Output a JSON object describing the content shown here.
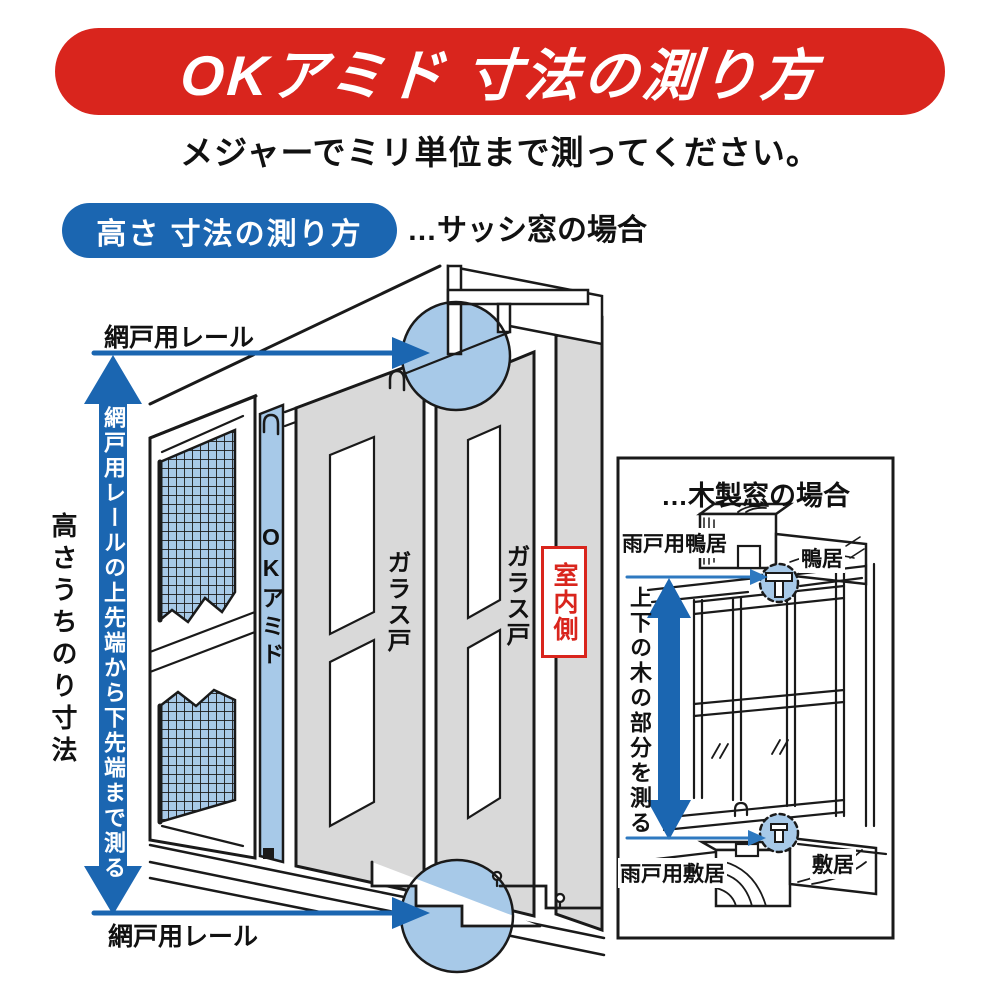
{
  "header": {
    "title": "OKアミド 寸法の測り方",
    "subtitle": "メジャーでミリ単位まで測ってください。"
  },
  "section": {
    "badge_label": "高さ 寸法の測り方",
    "case_label": "…サッシ窓の場合"
  },
  "sash_diagram": {
    "rail_label_top": "網戸用レール",
    "rail_label_bottom": "網戸用レール",
    "measure_note": "網戸用レールの上先端から下先端まで測る",
    "height_label": "高さうちのり寸法",
    "product_label": "OKアミド",
    "glass_door_label_1": "ガラス戸",
    "glass_door_label_2": "ガラス戸",
    "indoor_label": "室内側"
  },
  "wooden_panel": {
    "title": "…木製窓の場合",
    "top_left_label": "雨戸用鴨居",
    "top_right_label": "鴨居",
    "measure_note": "上下の木の部分を測る",
    "bottom_left_label": "雨戸用敷居",
    "bottom_right_label": "敷居"
  },
  "colors": {
    "accent_red": "#d9251d",
    "accent_blue": "#1b66b1",
    "thin_arrow_blue": "#2e79c0",
    "highlight_light_blue": "#a7c9e8",
    "panel_gray": "#d9d9d9",
    "line_black": "#1a1a1a"
  }
}
